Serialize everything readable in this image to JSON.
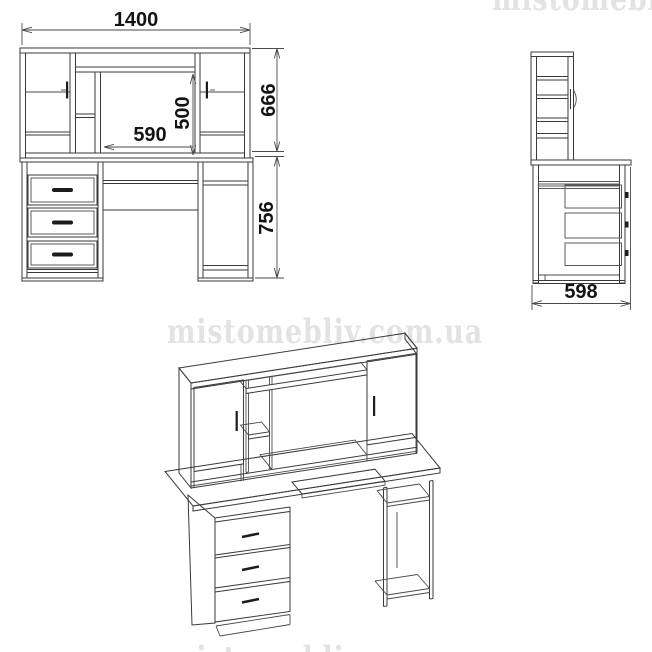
{
  "watermark": {
    "text": "mistomebliv.com.ua",
    "color": "#e3e3e3"
  },
  "drawing": {
    "line_color": "#3a3a3a",
    "views": {
      "front": {
        "dimensions": {
          "overall_width": "1400",
          "hutch_height": "666",
          "desk_height": "756",
          "niche_width": "590",
          "niche_height": "500"
        }
      },
      "side": {
        "dimensions": {
          "depth": "598"
        }
      }
    }
  }
}
